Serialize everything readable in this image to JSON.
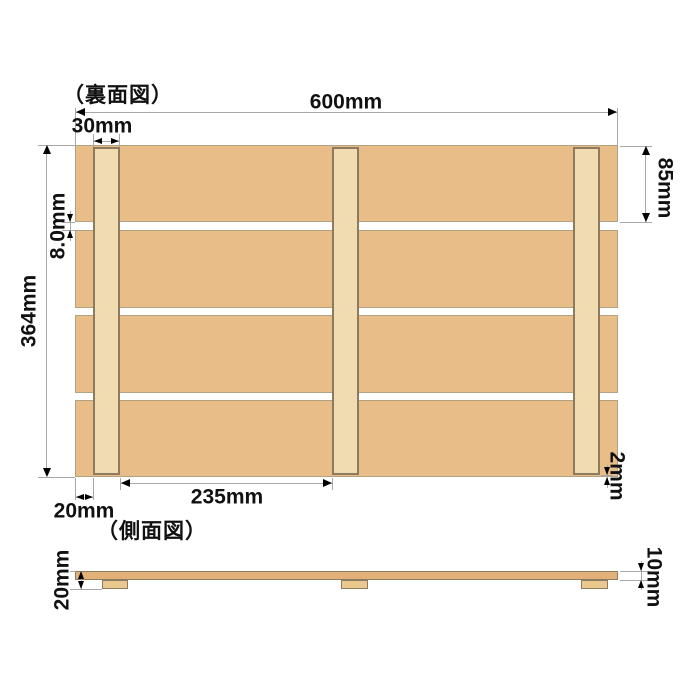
{
  "back_view": {
    "title": "（裏面図）",
    "dimensions": {
      "total_width": "600mm",
      "beam_width": "30mm",
      "slat_height": "85mm",
      "slat_gap": "8.0mm",
      "total_height": "364mm",
      "beam_spacing": "235mm",
      "beam_side_inset": "20mm",
      "beam_end_inset": "2mm"
    }
  },
  "side_view": {
    "title": "（側面図）",
    "dimensions": {
      "total_thickness": "20mm",
      "slat_thickness": "10mm"
    }
  },
  "colors": {
    "background": "#ffffff",
    "slat_fill": "#e9bd87",
    "slat_edge": "#b3a184",
    "beam_fill": "#f0dcb0",
    "beam_edge": "#8d7b5f",
    "side_slat_fill": "#e2b179",
    "side_beam_fill": "#eac890",
    "dim_line": "#a8a8a8",
    "dim_text": "#111111",
    "arrow": "#000000"
  }
}
